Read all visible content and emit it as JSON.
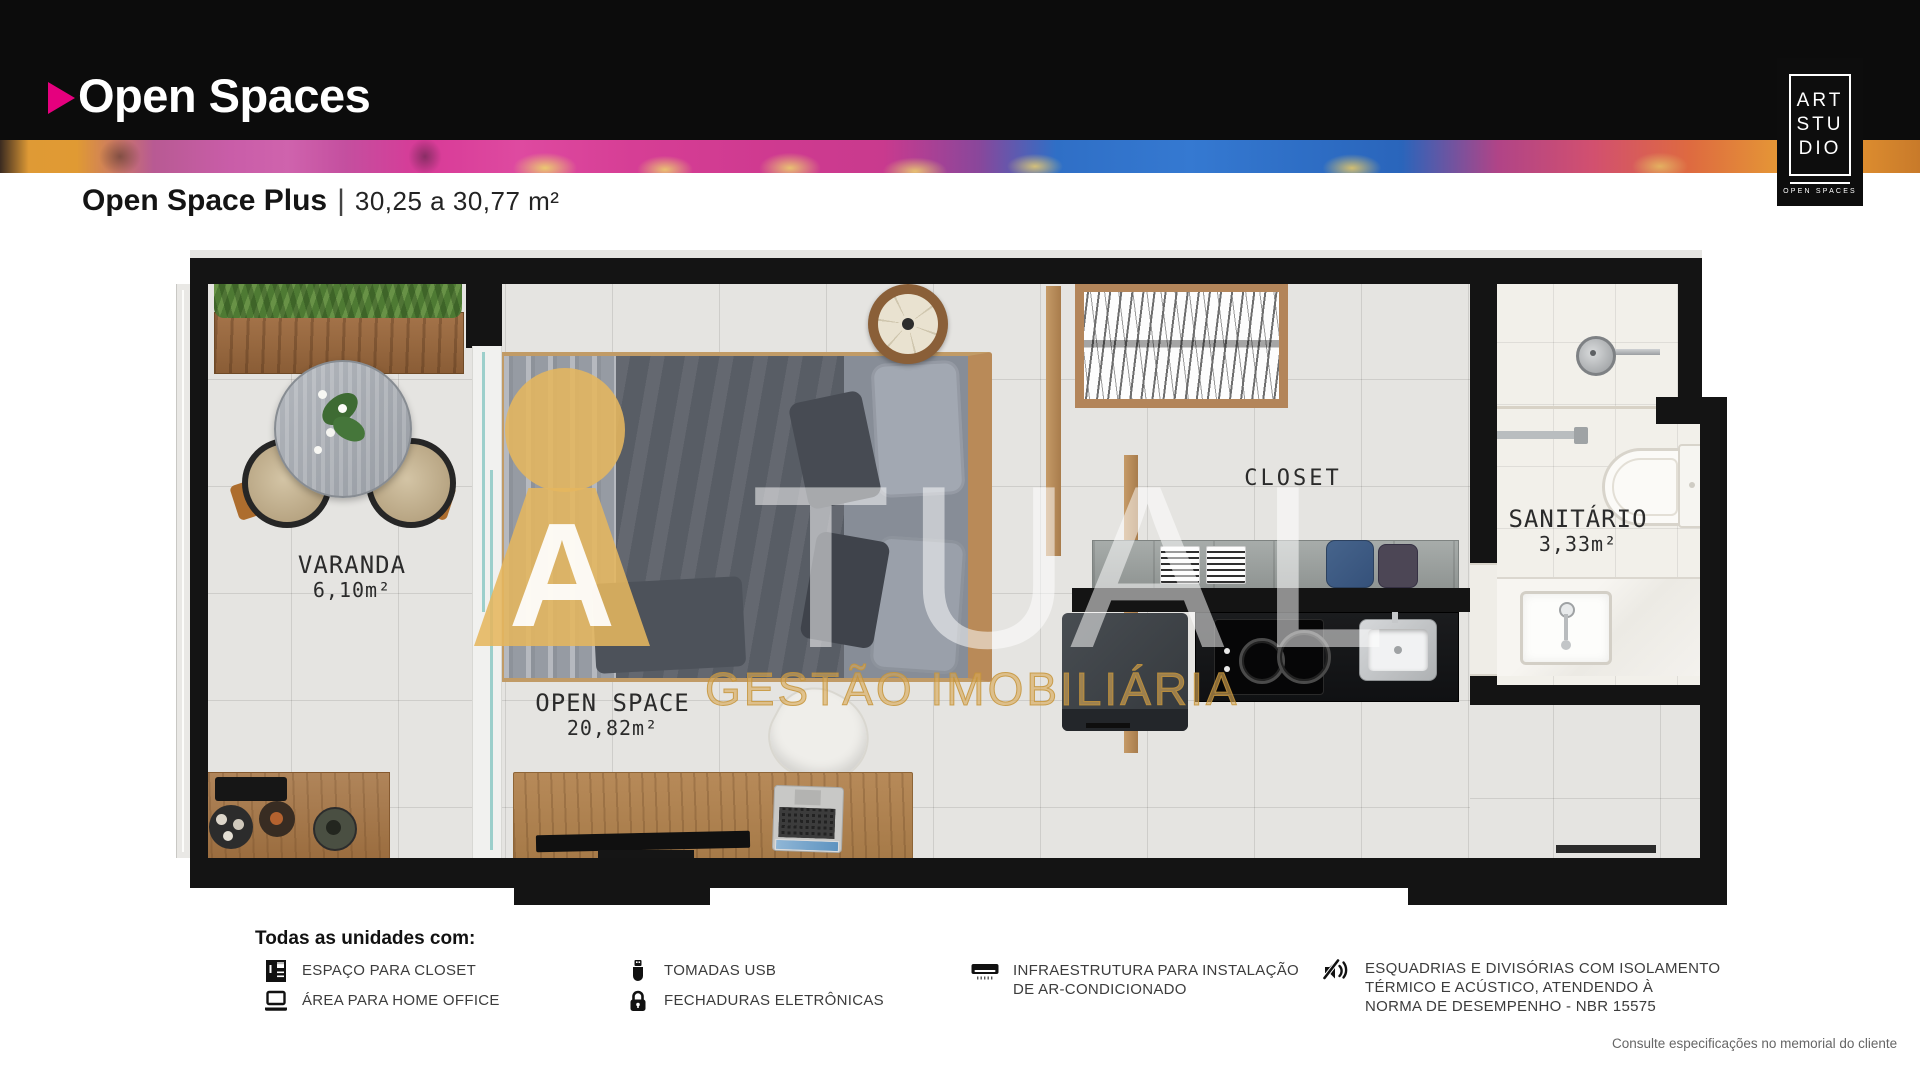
{
  "header": {
    "title": "Open Spaces"
  },
  "brand_logo": {
    "line1": "ART",
    "line2": "STU",
    "line3": "DIO",
    "caption": "OPEN SPACES"
  },
  "plan_header": {
    "name": "Open Space Plus",
    "separator": "|",
    "area_range": "30,25 a 30,77 m²"
  },
  "floorplan": {
    "rooms": [
      {
        "name": "VARANDA",
        "area": "6,10m²"
      },
      {
        "name": "OPEN SPACE",
        "area": "20,82m²"
      },
      {
        "name": "CLOSET",
        "area": ""
      },
      {
        "name": "SANITÁRIO",
        "area": "3,33m²"
      }
    ]
  },
  "watermark": {
    "logo_letter": "A",
    "letters": [
      "T",
      "U",
      "A",
      "L"
    ],
    "tagline": "GESTÃO IMOBILIÁRIA",
    "gold": "#DDAF5E"
  },
  "legend": {
    "title": "Todas as unidades com:",
    "items": [
      {
        "icon": "closet-icon",
        "label": "ESPAÇO PARA CLOSET"
      },
      {
        "icon": "laptop-icon",
        "label": "ÁREA PARA HOME OFFICE"
      },
      {
        "icon": "usb-icon",
        "label": "TOMADAS USB"
      },
      {
        "icon": "lock-icon",
        "label": "FECHADURAS ELETRÔNICAS"
      },
      {
        "icon": "ac-icon",
        "label": "INFRAESTRUTURA PARA INSTALAÇÃO\nDE AR-CONDICIONADO"
      },
      {
        "icon": "sound-insulation-icon",
        "label": "ESQUADRIAS E DIVISÓRIAS COM ISOLAMENTO\nTÉRMICO E ACÚSTICO, ATENDENDO À\nNORMA DE DESEMPENHO - NBR 15575"
      }
    ]
  },
  "footnote": "Consulte especificações no memorial do cliente",
  "colors": {
    "accent_pink": "#E5007E",
    "wall_black": "#141414",
    "watermark_gold": "#DDAF5E"
  }
}
